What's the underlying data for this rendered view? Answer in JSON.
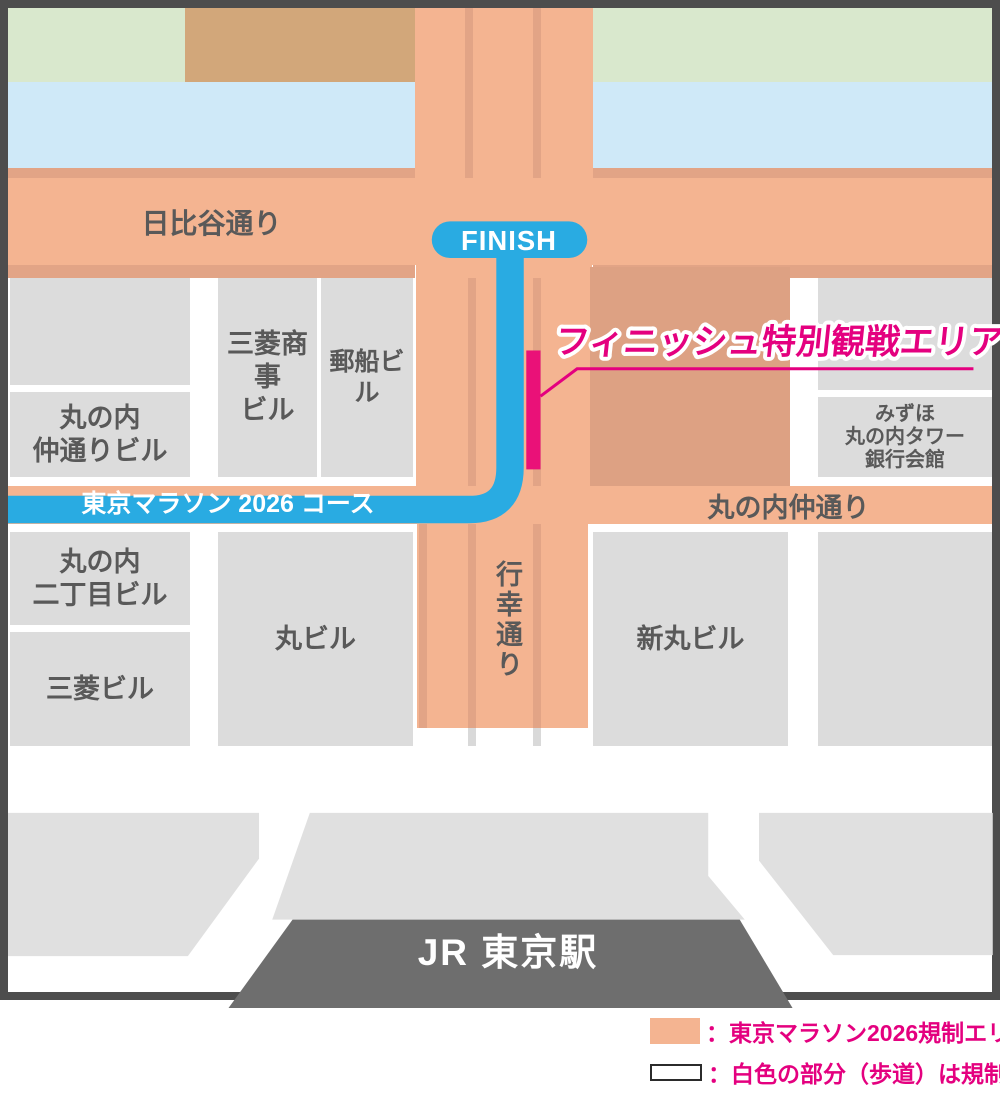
{
  "map": {
    "roads": {
      "hibiya": "日比谷通り",
      "gyoko": "行幸通り",
      "nakadori": "丸の内仲通り"
    },
    "course": {
      "finish_badge": "FINISH",
      "course_label": "東京マラソン 2026 コース",
      "special_area_label": "フィニッシュ特別観戦エリア"
    },
    "buildings": {
      "naka": [
        "丸の内",
        "仲通りビル"
      ],
      "mitsubishi_shoji": [
        "三菱商事",
        "ビル"
      ],
      "yusen": [
        "郵船ビル"
      ],
      "mizuho": [
        "みずほ",
        "丸の内タワー",
        "銀行会館"
      ],
      "nichome": [
        "丸の内",
        "二丁目ビル"
      ],
      "mitsubishi": [
        "三菱ビル"
      ],
      "maru": [
        "丸ビル"
      ],
      "shinmaru": [
        "新丸ビル"
      ]
    },
    "station": "JR 東京駅"
  },
  "legend": {
    "restricted_label": "：東京マラソン2026規制エリア",
    "sidewalk_label": "：白色の部分（歩道）は規制外"
  },
  "colors": {
    "restricted_area_orange": "#f4b491",
    "road_shadow_dark": "#e2a486",
    "plaza_dark": "#dda183",
    "course_blue": "#29abe2",
    "accent_magenta": "#e4007f",
    "viewing_area_pink": "#ea1178",
    "building_gray": "#dcdcdc",
    "plaza_gray": "#e0e0e0",
    "station_gray": "#6e6e6e",
    "water_blue": "#cfe9f8",
    "park_green": "#d9e8cd",
    "park_tan": "#d2a77a",
    "frame_dark": "#4d4d4d",
    "label_gray": "#595959",
    "sidewalk_white": "#ffffff"
  }
}
